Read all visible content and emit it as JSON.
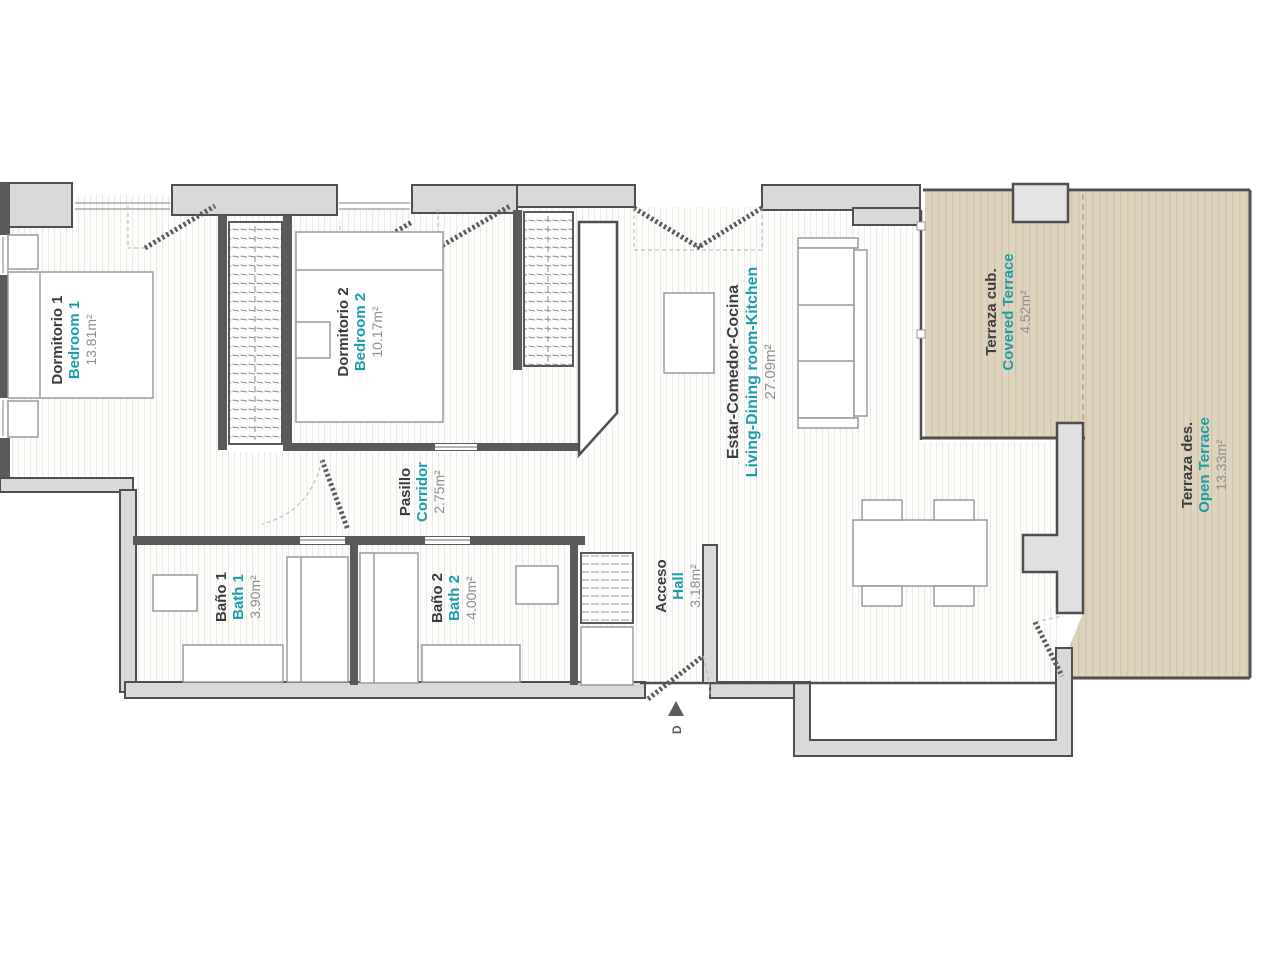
{
  "plan": {
    "rooms": [
      {
        "name_es": "Dormitorio 1",
        "name_en": "Bedroom 1",
        "area": "13.81m²"
      },
      {
        "name_es": "Dormitorio 2",
        "name_en": "Bedroom 2",
        "area": "10.17m²"
      },
      {
        "name_es": "Pasillo",
        "name_en": "Corridor",
        "area": "2.75m²"
      },
      {
        "name_es": "Baño 1",
        "name_en": "Bath 1",
        "area": "3.90m²"
      },
      {
        "name_es": "Baño 2",
        "name_en": "Bath 2",
        "area": "4.00m²"
      },
      {
        "name_es": "Acceso",
        "name_en": "Hall",
        "area": "3.18m²"
      },
      {
        "name_es": "Estar-Comedor-Cocina",
        "name_en": "Living-Dining room-Kitchen",
        "area": "27.09m²"
      },
      {
        "name_es": "Terraza cub.",
        "name_en": "Covered Terrace",
        "area": "4.52m²"
      },
      {
        "name_es": "Terraza des.",
        "name_en": "Open Terrace",
        "area": "13.33m²"
      }
    ],
    "entrance_label": "D",
    "colors": {
      "accent_teal": "#1d9daa",
      "text_dark": "#3d3d3d",
      "text_gray": "#8f8f8f",
      "wall_line": "#4f4f4f",
      "wall_fill": "#d9d9d9",
      "terrace_fill": "#ded3bd"
    }
  }
}
